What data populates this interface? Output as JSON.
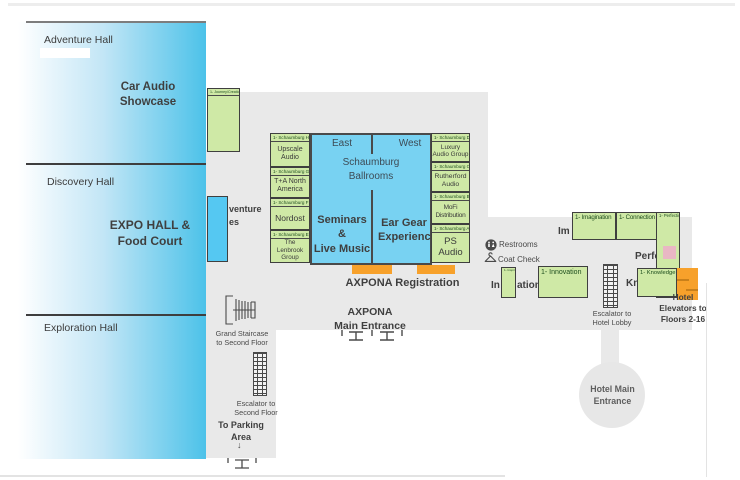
{
  "colors": {
    "hall_blue": "#4cc2e9",
    "ballroom_blue": "#78d2f2",
    "booth_green": "#cfe9a6",
    "accent_orange": "#f7a12b",
    "floor_gray": "#e9e9e9",
    "pink_swatch": "#e9b7c4"
  },
  "halls": {
    "adventure": {
      "name": "Adventure Hall",
      "feature": "Car Audio\nShowcase"
    },
    "discovery": {
      "name": "Discovery Hall",
      "feature": "EXPO HALL &\nFood Court"
    },
    "exploration": {
      "name": "Exploration Hall"
    }
  },
  "ballrooms": {
    "east": "East",
    "west": "West",
    "name": "Schaumburg\nBallrooms",
    "seminars": "Seminars &\nLive Music",
    "ear_gear": "Ear Gear\nExperience"
  },
  "booths": {
    "journey": {
      "room": "1- Journey/Creation"
    },
    "sch_h": {
      "room": "1- Schaumburg H",
      "exhibitor": "Upscale\nAudio"
    },
    "sch_g": {
      "room": "1- Schaumburg G",
      "exhibitor": "T+A North\nAmerica"
    },
    "sch_f": {
      "room": "1- Schaumburg F",
      "exhibitor": "Nordost"
    },
    "sch_e": {
      "room": "1- Schaumburg E",
      "exhibitor": "The Lenbrook\nGroup"
    },
    "sch_d": {
      "room": "1- Schaumburg D",
      "exhibitor": "Luxury\nAudio Group"
    },
    "sch_c": {
      "room": "1- Schaumburg C",
      "exhibitor": "Rutherford\nAudio"
    },
    "sch_b": {
      "room": "1- Schaumburg B",
      "exhibitor": "MoFi\nDistribution"
    },
    "sch_a": {
      "room": "1- Schaumburg A",
      "exhibitor": "PS Audio"
    },
    "imagination": {
      "room": "1- Imagination"
    },
    "connection": {
      "room": "1- Connection"
    },
    "perfection": {
      "room": "1- Perfection"
    },
    "innovation": {
      "room": "1- Innovation"
    },
    "inspiration": {
      "room": "1- Inspiration"
    },
    "knowledge": {
      "room": "1- Knowledge"
    }
  },
  "room_fragments": {
    "adventure_suites": "venture\nes",
    "imagination": "Im",
    "perfection": "Perfe",
    "inspiration_left": "In",
    "inspiration_right": "ation",
    "knowledge": "Kn"
  },
  "labels": {
    "registration": "AXPONA Registration",
    "main_entrance": "AXPONA\nMain Entrance",
    "grand_staircase": "Grand Staircase\nto Second Floor",
    "escalator_second": "Escalator to\nSecond Floor",
    "to_parking": "To Parking\nArea",
    "parking_arrow": "↓",
    "restrooms": "Restrooms",
    "coat_check": "Coat Check",
    "escalator_hotel": "Escalator to\nHotel Lobby",
    "hotel_elevators": "Hotel\nElevators to\nFloors 2-16",
    "hotel_main_entrance": "Hotel Main\nEntrance"
  }
}
